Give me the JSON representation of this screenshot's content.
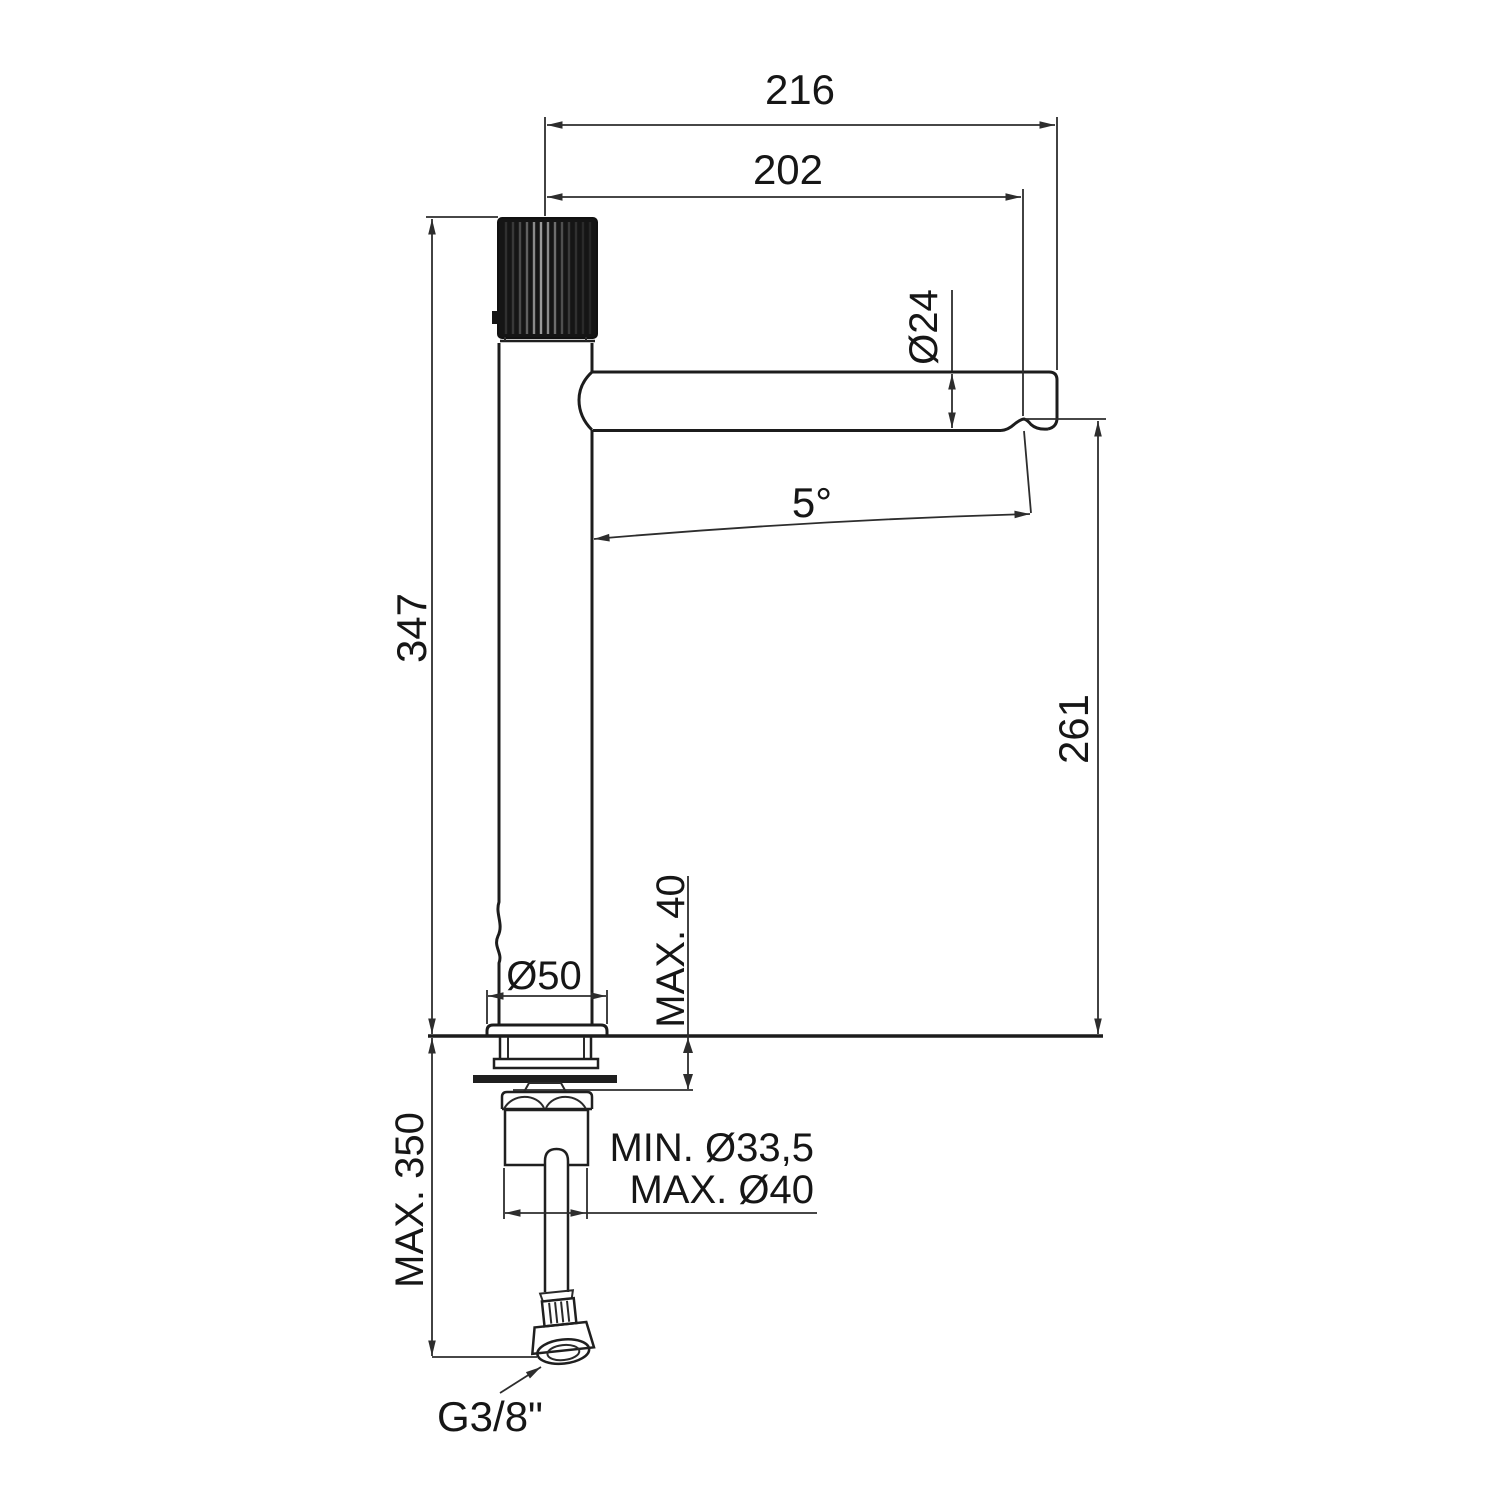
{
  "drawing": {
    "labels": {
      "total_reach": "216",
      "spout_reach": "202",
      "spout_diameter": "Ø24",
      "spout_tilt": "5°",
      "total_height": "347",
      "outlet_height": "261",
      "base_diameter": "Ø50",
      "max_deck_thickness": "MAX. 40",
      "max_hose_drop": "MAX. 350",
      "hole_min": "MIN. Ø33,5",
      "hole_max": "MAX. Ø40",
      "supply_thread": "G3/8\""
    }
  }
}
